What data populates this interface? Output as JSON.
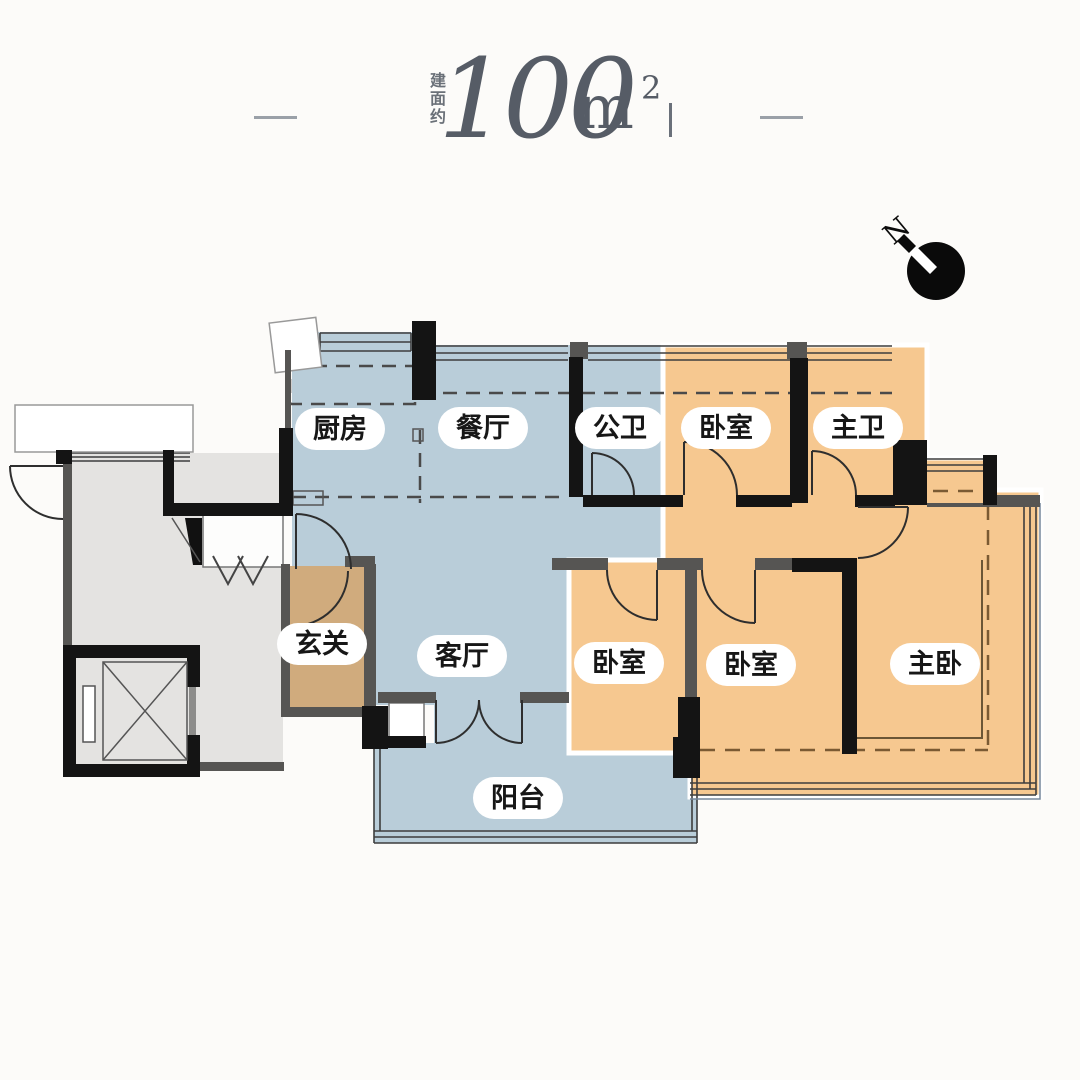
{
  "title": {
    "area_prefix": "建面约",
    "area_value": "100",
    "area_unit": "m",
    "area_superscript": "2"
  },
  "compass": {
    "north_label": "N"
  },
  "rooms": {
    "kitchen": {
      "label": "厨房"
    },
    "dining": {
      "label": "餐厅"
    },
    "public_bath": {
      "label": "公卫"
    },
    "bedroom_north": {
      "label": "卧室"
    },
    "master_bath": {
      "label": "主卫"
    },
    "foyer": {
      "label": "玄关"
    },
    "living": {
      "label": "客厅"
    },
    "bedroom_west": {
      "label": "卧室"
    },
    "bedroom_middle": {
      "label": "卧室"
    },
    "master_bedroom": {
      "label": "主卧"
    },
    "balcony": {
      "label": "阳台"
    }
  },
  "colors": {
    "public_zone_fill": "#b9cdd9",
    "private_zone_fill": "#f6c890",
    "foyer_fill": "#d0ab7d",
    "common_area_fill": "#e4e3e1",
    "wall": "#141414",
    "wall_gray": "#565553",
    "title_text": "#565c66",
    "background": "#fcfbf9"
  }
}
